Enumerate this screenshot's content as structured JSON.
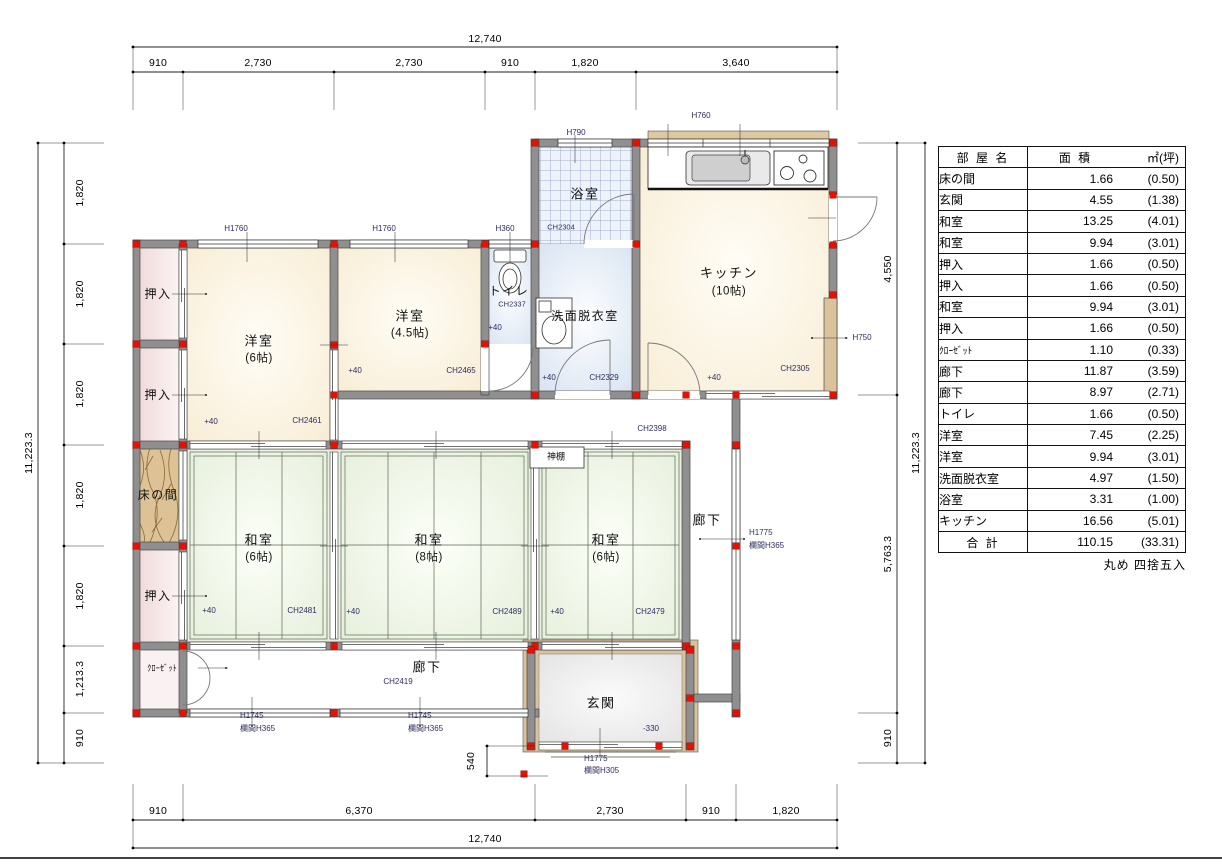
{
  "plan": {
    "rooms": {
      "yoshitsu6": {
        "name": "洋室",
        "size": "(6帖)",
        "level": "+40",
        "ch": "CH2461"
      },
      "yoshitsu45": {
        "name": "洋室",
        "size": "(4.5帖)",
        "level": "+40",
        "ch": "CH2465"
      },
      "washitsu6_left": {
        "name": "和室",
        "size": "(6帖)",
        "level": "+40",
        "ch": "CH2481"
      },
      "washitsu8": {
        "name": "和室",
        "size": "(8帖)",
        "level": "+40",
        "ch": "CH2489"
      },
      "washitsu6_right": {
        "name": "和室",
        "size": "(6帖)",
        "level": "+40",
        "ch": "CH2479"
      },
      "kitchen": {
        "name": "キッチン",
        "size": "(10帖)",
        "level": "+40",
        "ch": "CH2305"
      },
      "bath": {
        "name": "浴室",
        "ch": "CH2304"
      },
      "toilet": {
        "name": "トイレ",
        "ch": "CH2337",
        "level": "+40"
      },
      "washroom": {
        "name": "洗面脱衣室",
        "level": "+40",
        "ch": "CH2329"
      },
      "genkan": {
        "name": "玄関",
        "level": "-330"
      },
      "oshiire_a": {
        "name": "押入"
      },
      "oshiire_b": {
        "name": "押入"
      },
      "oshiire_c": {
        "name": "押入"
      },
      "tokonoma": {
        "name": "床の間"
      },
      "closet": {
        "name": "ｸﾛｰｾﾞｯﾄ"
      },
      "kamidana": {
        "name": "神棚"
      },
      "corridor_east": {
        "name": "廊下"
      },
      "corridor_south": {
        "name": "廊下",
        "ch": "CH2419"
      },
      "corridor_mid_ch": "CH2398"
    },
    "openings": {
      "win_yoshitsu6": "H1760",
      "win_yoshitsu45": "H1760",
      "win_toilet": "H360",
      "win_bath": "H790",
      "win_kitchen": "H760",
      "door_kitchen_side": "H750",
      "corridor_east_h": "H1775",
      "corridor_east_ranma": "欄間H365",
      "corridor_south_a_h": "H1745",
      "corridor_south_a_ranma": "欄間H365",
      "corridor_south_b_h": "H1745",
      "corridor_south_b_ranma": "欄間H365",
      "genkan_h": "H1775",
      "genkan_ranma": "欄間H305"
    }
  },
  "dims": {
    "top": {
      "total": "12,740",
      "segments": [
        "910",
        "2,730",
        "2,730",
        "910",
        "1,820",
        "3,640"
      ]
    },
    "bottom": {
      "total": "12,740",
      "segments": [
        "910",
        "6,370",
        "2,730",
        "910",
        "1,820"
      ],
      "entry_step": "540"
    },
    "left": {
      "total": "11,223.3",
      "segments": [
        "1,820",
        "1,820",
        "1,820",
        "1,820",
        "1,820",
        "1,213.3",
        "910"
      ]
    },
    "right": {
      "total": "11,223.3",
      "segments": [
        "4,550",
        "5,763.3",
        "910"
      ]
    }
  },
  "table": {
    "header": {
      "name": "部 屋 名",
      "area": "面 積",
      "unit": "㎡(坪)"
    },
    "rows": [
      {
        "name": "床の間",
        "area": "1.66",
        "tsubo": "(0.50)"
      },
      {
        "name": "玄関",
        "area": "4.55",
        "tsubo": "(1.38)"
      },
      {
        "name": "和室",
        "area": "13.25",
        "tsubo": "(4.01)"
      },
      {
        "name": "和室",
        "area": "9.94",
        "tsubo": "(3.01)"
      },
      {
        "name": "押入",
        "area": "1.66",
        "tsubo": "(0.50)"
      },
      {
        "name": "押入",
        "area": "1.66",
        "tsubo": "(0.50)"
      },
      {
        "name": "和室",
        "area": "9.94",
        "tsubo": "(3.01)"
      },
      {
        "name": "押入",
        "area": "1.66",
        "tsubo": "(0.50)"
      },
      {
        "name": "ｸﾛｰｾﾞｯﾄ",
        "area": "1.10",
        "tsubo": "(0.33)",
        "small": true
      },
      {
        "name": "廊下",
        "area": "11.87",
        "tsubo": "(3.59)"
      },
      {
        "name": "廊下",
        "area": "8.97",
        "tsubo": "(2.71)"
      },
      {
        "name": "トイレ",
        "area": "1.66",
        "tsubo": "(0.50)"
      },
      {
        "name": "洋室",
        "area": "7.45",
        "tsubo": "(2.25)"
      },
      {
        "name": "洋室",
        "area": "9.94",
        "tsubo": "(3.01)"
      },
      {
        "name": "洗面脱衣室",
        "area": "4.97",
        "tsubo": "(1.50)"
      },
      {
        "name": "浴室",
        "area": "3.31",
        "tsubo": "(1.00)"
      },
      {
        "name": "キッチン",
        "area": "16.56",
        "tsubo": "(5.01)"
      }
    ],
    "total": {
      "name": "合 計",
      "area": "110.15",
      "tsubo": "(33.31)"
    },
    "footnote": "丸め 四捨五入"
  },
  "colors": {
    "wall": "#8f8f8f",
    "pillar": "#e81000",
    "tatami": "#e7efdc",
    "wood_floor": "#f9efd9",
    "wet_room": "#dbe5f2",
    "closet": "#f1dada",
    "tokonoma_wood": "#dcc294",
    "porch": "#d9c29c"
  }
}
